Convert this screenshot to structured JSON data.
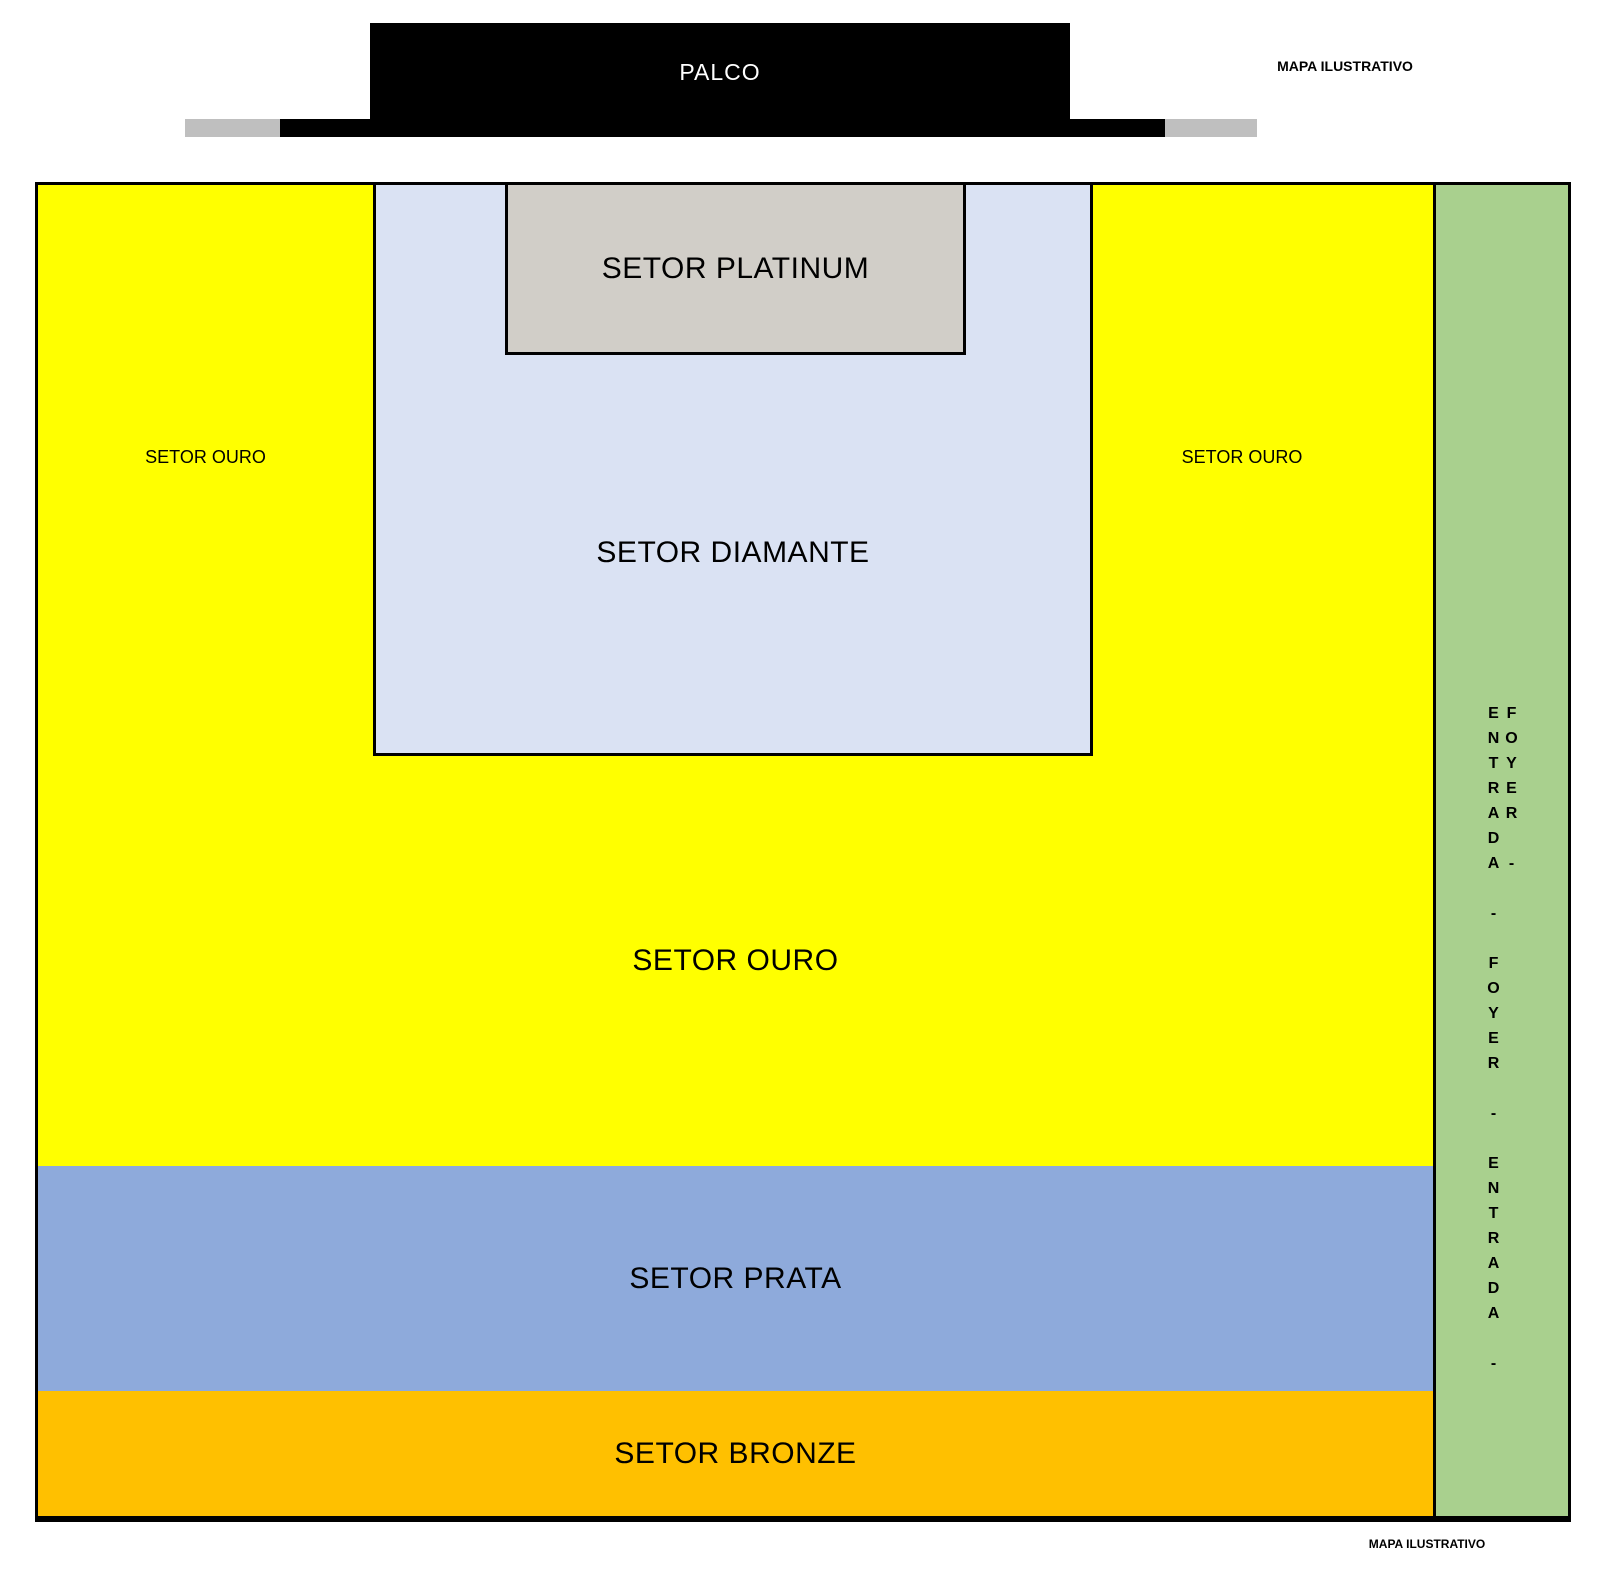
{
  "page": {
    "top_note": "MAPA ILUSTRATIVO",
    "bottom_note": "MAPA ILUSTRATIVO"
  },
  "stage": {
    "label": "PALCO"
  },
  "sectors": {
    "ouro": {
      "label": "SETOR OURO",
      "color": "#ffff00"
    },
    "ouro_left": {
      "label": "SETOR OURO"
    },
    "ouro_right": {
      "label": "SETOR OURO"
    },
    "platinum": {
      "label": "SETOR PLATINUM",
      "color": "#d1cec8"
    },
    "diamante": {
      "label": "SETOR DIAMANTE",
      "color": "#dae2f3"
    },
    "prata": {
      "label": "SETOR PRATA",
      "color": "#8eaadb"
    },
    "bronze": {
      "label": "SETOR BRONZE",
      "color": "#ffc000"
    },
    "entrance": {
      "label": "ENTRADA - FOYER - ENTRADA - FOYER -",
      "color": "#a9d08e"
    }
  },
  "colors": {
    "stage": "#000000",
    "stage_text": "#ffffff",
    "wing_gray": "#bfbfbf",
    "border": "#000000"
  }
}
